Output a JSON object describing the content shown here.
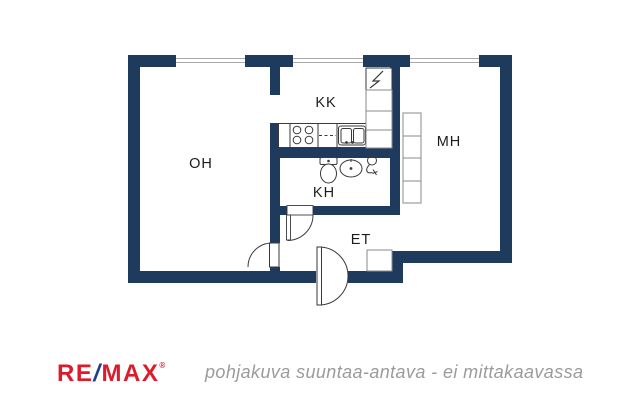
{
  "rooms": {
    "living": {
      "label": "OH"
    },
    "kitchenette": {
      "label": "KK"
    },
    "bedroom": {
      "label": "MH"
    },
    "bathroom": {
      "label": "KH"
    },
    "hallway": {
      "label": "ET"
    }
  },
  "footer": {
    "logo": {
      "re": "RE",
      "slash": "/",
      "max": "MAX",
      "registered": "®"
    },
    "caption": "pohjakuva suuntaa-antava - ei mittakaavassa"
  },
  "icons": {
    "lightning_cabinet": "lightning-zigzag",
    "stove": "stove-4-burners",
    "kitchen_sink": "double-bowl-sink",
    "toilet": "toilet-wc",
    "washbasin": "washbasin-oval",
    "shower": "hand-shower"
  },
  "colors": {
    "wall_navy": "#1e3a5c",
    "remax_red": "#dc1c2c",
    "remax_slash_blue": "#1f3e8f",
    "caption_gray": "#9b9b9b",
    "label_dark": "#1c1c1c",
    "fixture_line": "#3a3a3a",
    "cabinet_line": "#8a8a8a",
    "window_line": "#a8a8a8"
  }
}
